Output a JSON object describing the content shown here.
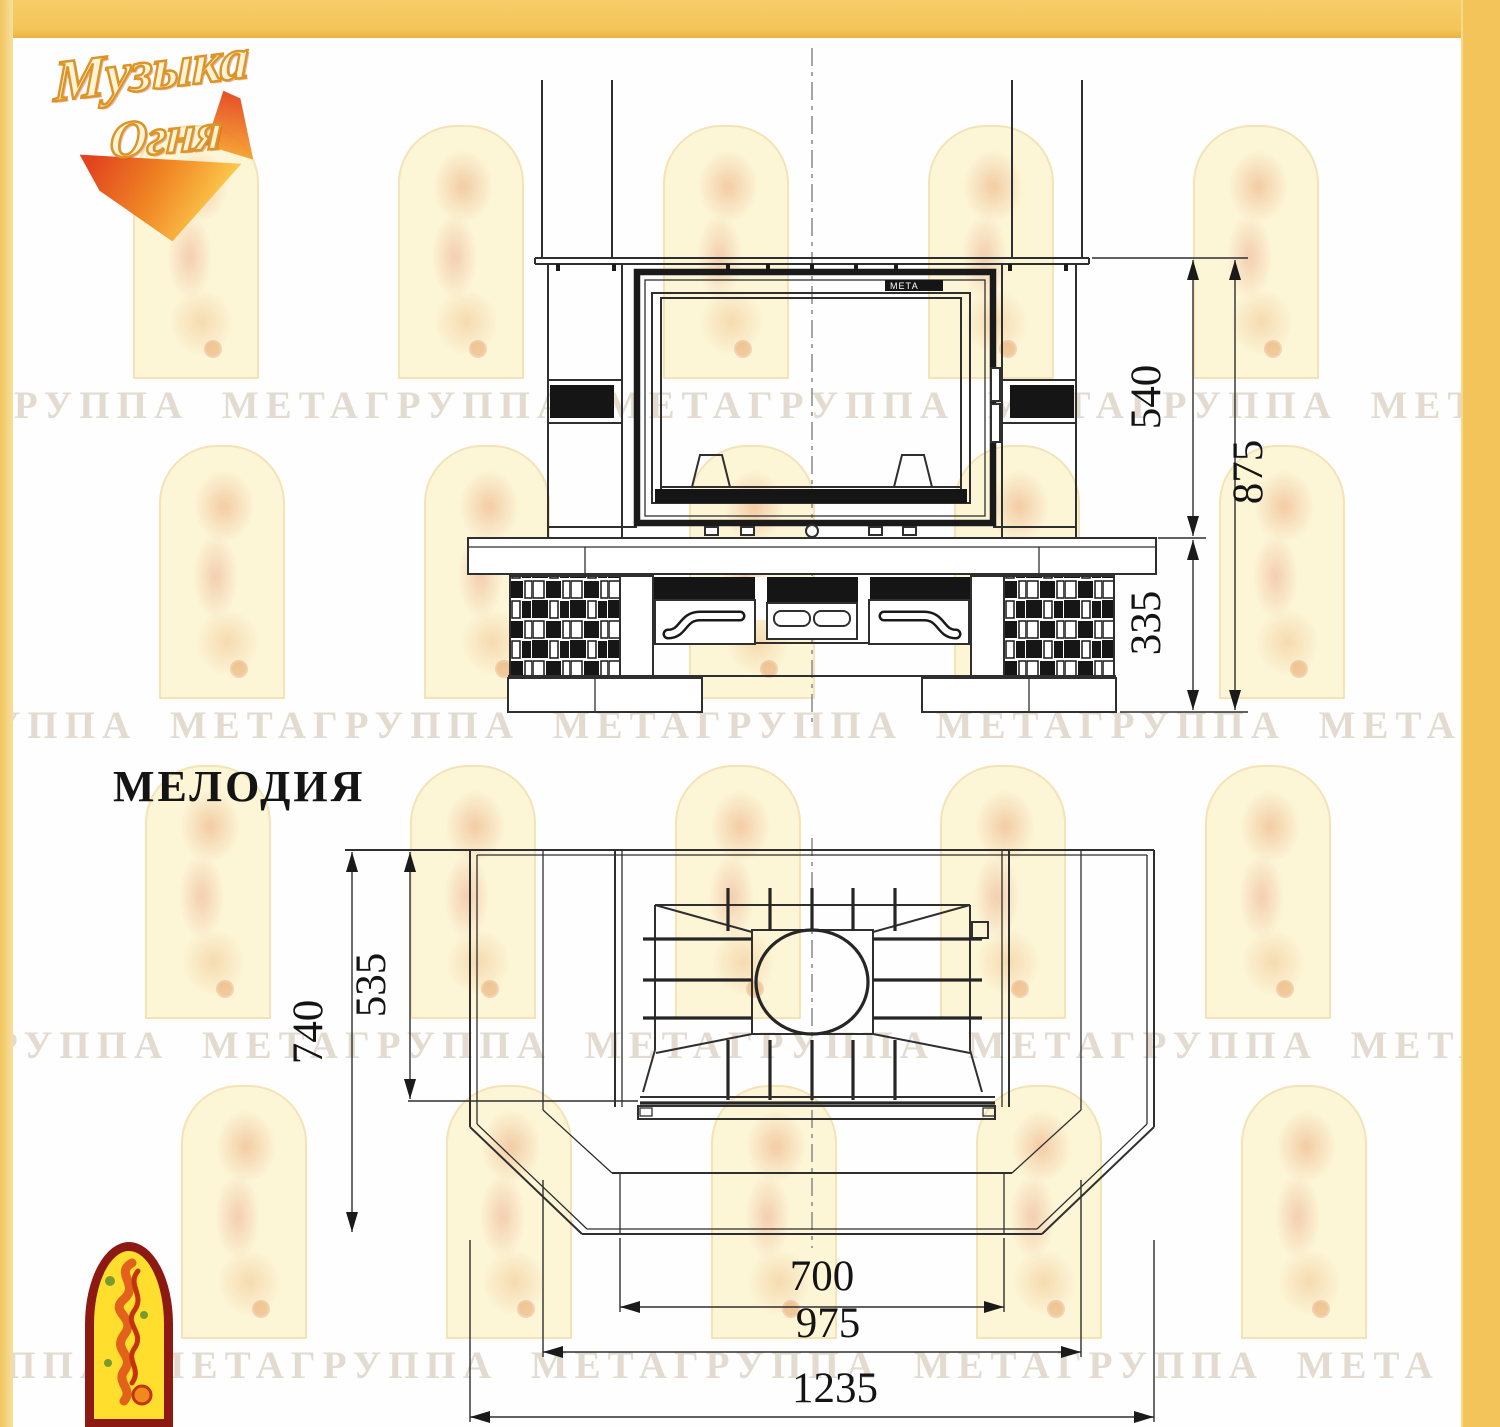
{
  "header": {
    "brand_logo_line1": "Музыка",
    "brand_logo_line2": "Огня"
  },
  "model": {
    "name": "МЕЛОДИЯ"
  },
  "firebox": {
    "door_brand_mark": "МЕТА"
  },
  "dimensions": {
    "front_opening_height": "540",
    "front_total_height": "875",
    "front_base_height": "335",
    "plan_total_depth": "740",
    "plan_inner_depth": "535",
    "plan_firebox_width": "700",
    "plan_inner_width": "975",
    "plan_total_width": "1235"
  },
  "watermark": {
    "text": "ГРУППА МЕТАГРУППА МЕТАГРУППА МЕТАГРУППА МЕТА",
    "rows_y": [
      383,
      703,
      1023,
      1343
    ],
    "row_offsets_x": [
      -18,
      -70,
      -38,
      -92
    ],
    "arch_cols": [
      133,
      398,
      663,
      928,
      1193
    ],
    "arch_rows": [
      125,
      445,
      765,
      1085
    ],
    "arch_row_offsets": [
      0,
      26,
      12,
      48
    ]
  },
  "colors": {
    "frame_yellow": "#f2c55e",
    "drawing_line": "#2f2f2f",
    "watermark_tint": "#e9dfc6",
    "logo_arch_red": "#8c1a12",
    "logo_arch_yellow": "#ffde2e",
    "logo_flame_orange": "#ef7f1a"
  }
}
